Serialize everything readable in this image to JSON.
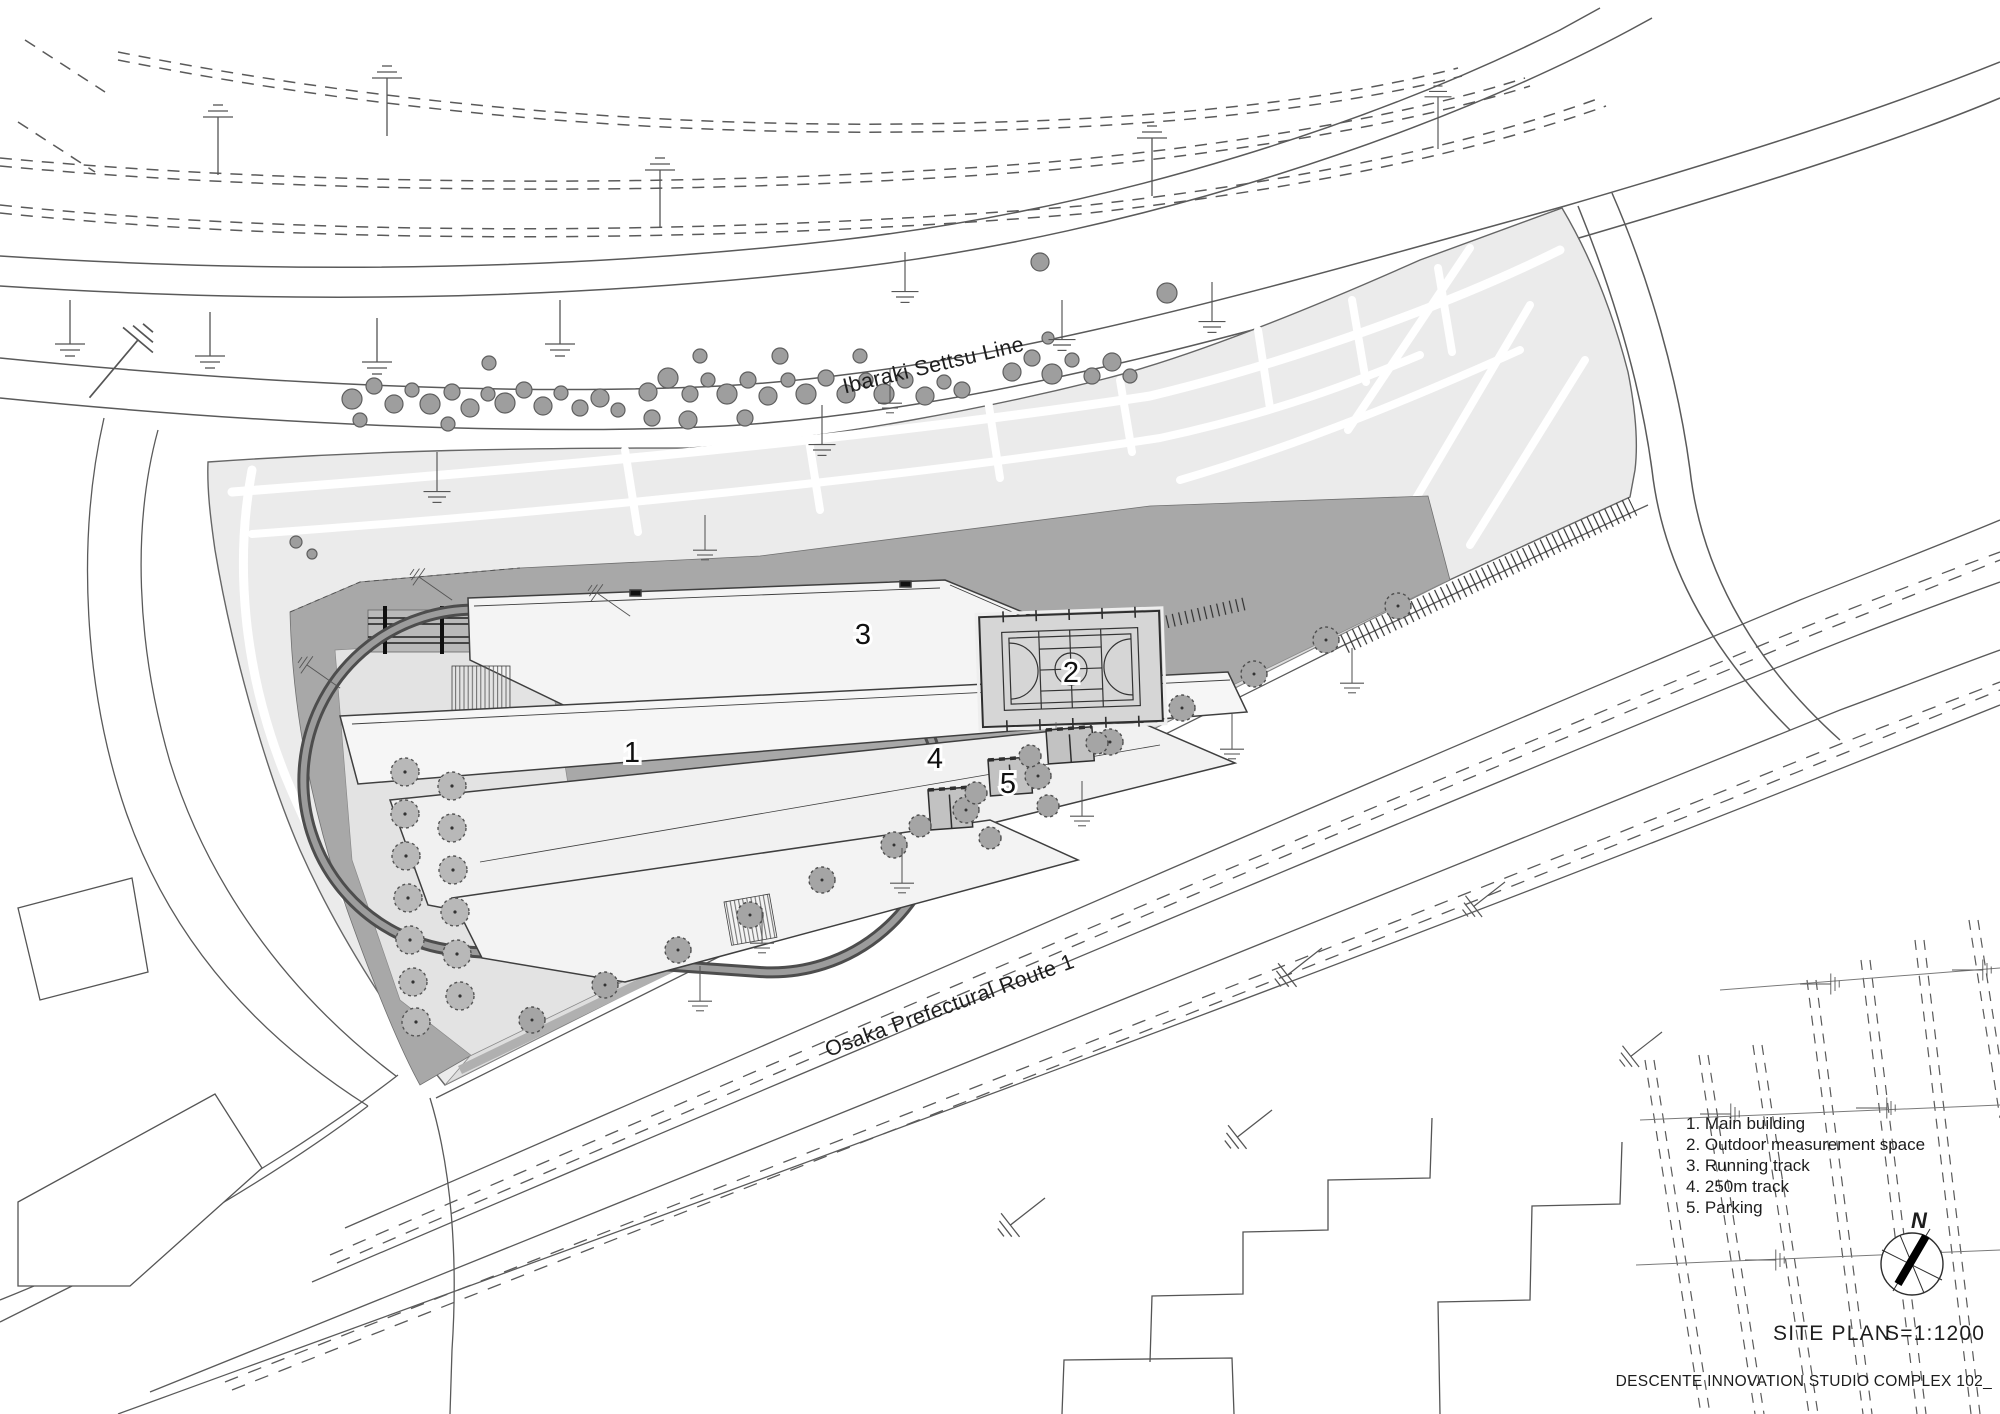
{
  "map": {
    "north_road_label": "Ibaraki Settsu Line",
    "south_road_label": "Osaka Prefectural Route 1"
  },
  "markers": {
    "m1": "1",
    "m2": "2",
    "m3": "3",
    "m4": "4",
    "m5": "5"
  },
  "legend": {
    "items": [
      "1. Main building",
      "2. Outdoor measurement space",
      "3. Running track",
      "4. 250m track",
      "5. Parking"
    ]
  },
  "compass": {
    "label": "N"
  },
  "title": {
    "name": "SITE PLAN",
    "scale": "S=1:1200"
  },
  "footer": {
    "text": "DESCENTE INNOVATION STUDIO COMPLEX 102_"
  },
  "colors": {
    "site": "#ebebeb",
    "plaza": "#a8a8a8",
    "court": "#d6d6d6",
    "ink": "#3a3a3a"
  }
}
